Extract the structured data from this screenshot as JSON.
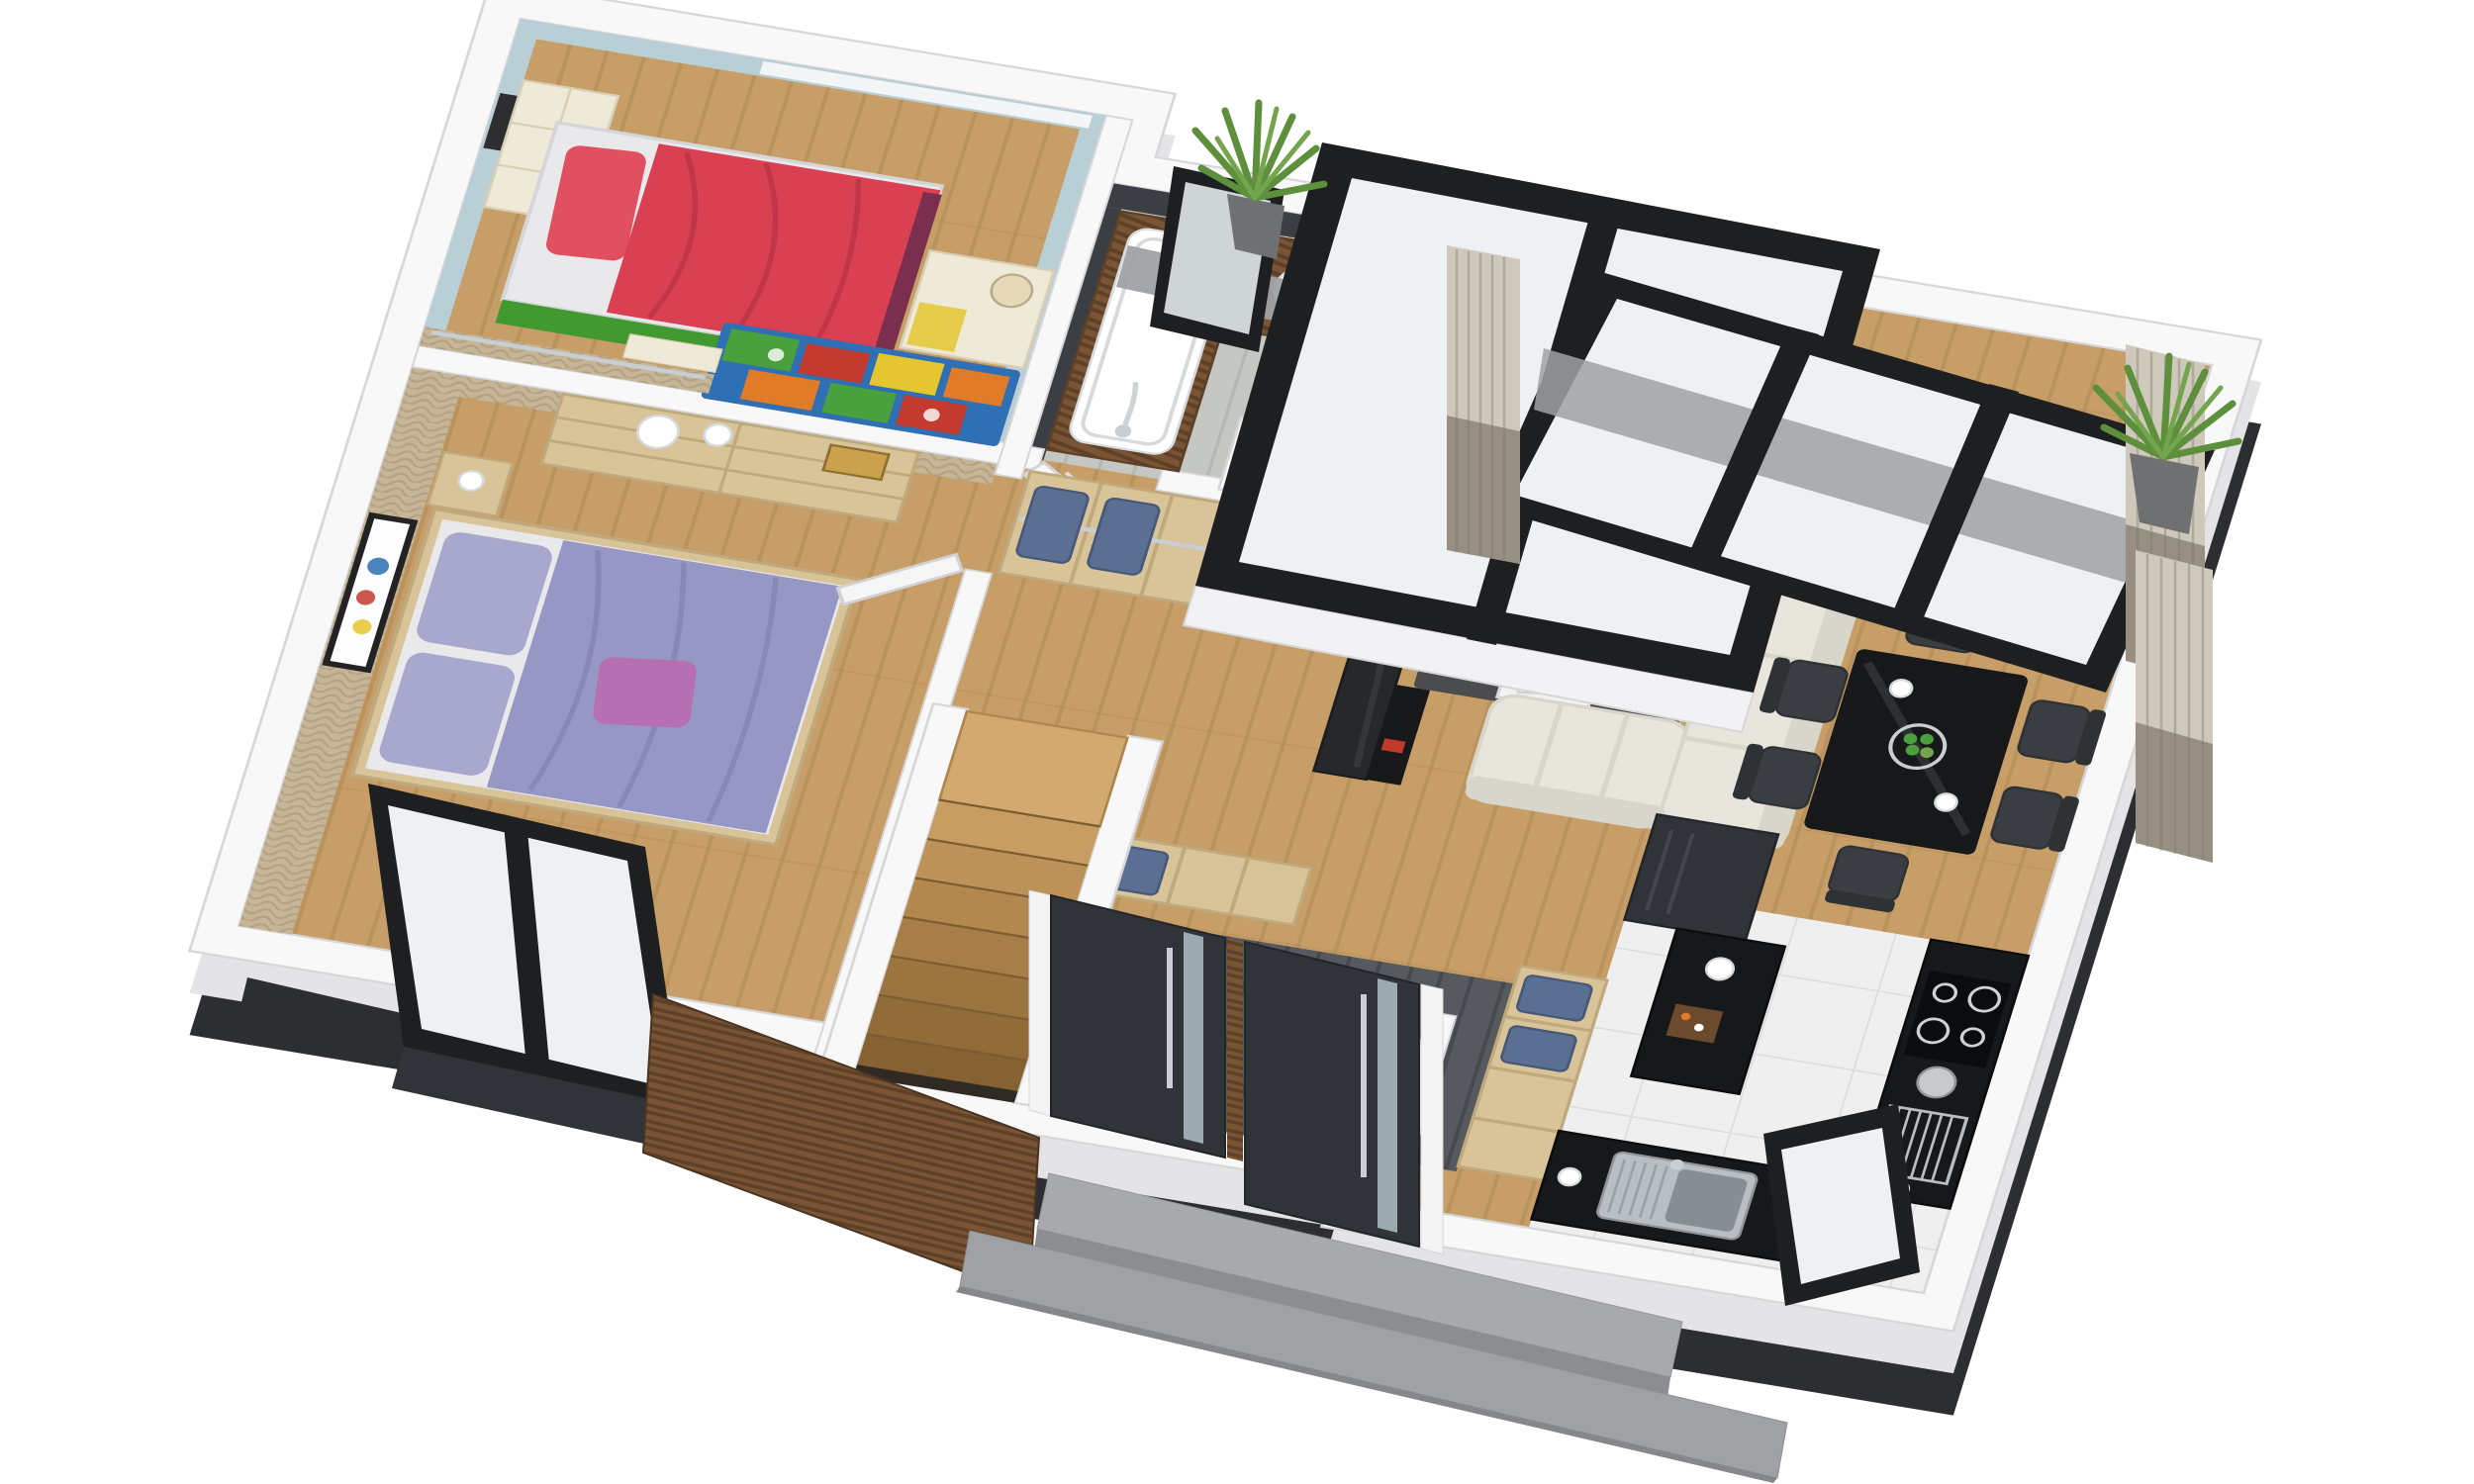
{
  "scene": {
    "type": "3d-isometric-floor-plan-render",
    "background": "white, no visible text or dimensions",
    "rooms": [
      {
        "name": "children-bedroom",
        "position": "top-left",
        "floor": "oak-wood",
        "walls": "light-blue",
        "items": [
          "red-single-bed-green-base",
          "cream-wall-shelf",
          "picture-frame",
          "desk-with-lamp",
          "lime-chair",
          "colorful-play-rug",
          "clothes-rail",
          "black-frame-window-two-panes"
        ]
      },
      {
        "name": "master-bedroom",
        "position": "left",
        "floor": "oak-wood",
        "walls": "wicker-weave",
        "items": [
          "double-bed-lavender-bedding",
          "pink-accent-pillow",
          "six-drawer-dresser",
          "two-white-bowls",
          "books",
          "nightstand-with-vase",
          "colorful-art-frame",
          "white-louver-door",
          "black-frame-sliding-glass-door"
        ]
      },
      {
        "name": "bathroom",
        "position": "top-center",
        "floor": "gray-plank-tile",
        "walls": "anthracite-tile",
        "items": [
          "bathtub-wood-deck",
          "chrome-faucet-running-water",
          "rubber-duck",
          "walnut-vanity-round-vessel-sink",
          "tall-chrome-faucet",
          "vases",
          "toilet",
          "half-wall-niche",
          "framed-mirror",
          "white-louver-door"
        ]
      },
      {
        "name": "hallway",
        "position": "center",
        "floor": "oak-wood",
        "walls": "white",
        "items": [
          "open-wardrobe-cubbies-with-folded-jeans",
          "clothes-rails",
          "winder-staircase-down",
          "second-wardrobe-row",
          "entry-wardrobe-cubbies"
        ]
      },
      {
        "name": "living-dining-room",
        "position": "right",
        "floor": "oak-wood",
        "walls": "white",
        "items": [
          "black-tv-media-wall",
          "red-book",
          "dark-gray-rug",
          "black-coffee-table",
          "bowl-of-green-apples",
          "candle",
          "white-cube-side-tables",
          "magazine",
          "cream-l-shaped-sofa",
          "black-gloss-dining-table",
          "six-dark-chairs",
          "two-white-cups",
          "floor-to-ceiling-black-window",
          "gray-curtains",
          "potted-palms"
        ]
      },
      {
        "name": "kitchen",
        "position": "bottom-right",
        "floor": "white-tile",
        "walls": "white",
        "items": [
          "tall-charcoal-cabinet",
          "black-gloss-counters",
          "ceramic-hob-four-rings",
          "steel-kettle",
          "chrome-dish-rack",
          "stainless-sink-with-drainer",
          "black-frame-window",
          "cutting-board-with-food",
          "white-cups"
        ]
      },
      {
        "name": "entrance",
        "position": "bottom-center",
        "floor": "dark-plank-tile",
        "walls": "white",
        "items": [
          "two-anthracite-front-doors",
          "frosted-glass-strips",
          "steel-bar-handles",
          "walnut-slat-wall",
          "walnut-pillar",
          "two-concrete-steps"
        ]
      }
    ]
  },
  "palette": {
    "bg": "#ffffff",
    "wallTop": "#f8f8f9",
    "wallLine": "#d7d7da",
    "wallSide": "#e4e4e7",
    "plinth": "#2c2e31",
    "wood": "#c79e67",
    "woodDark": "#aa8350",
    "bathFloor": "#c4c7c2",
    "bathFloorDark": "#a9ada7",
    "tile": "#efeff0",
    "tileLine": "#dcdcde",
    "vestibule": "#56595d",
    "vestibuleDark": "#46494d",
    "wicker": "#c6b697",
    "wickerDark": "#ab9a7c",
    "blueWall": "#b9cfd6",
    "cream": "#efe9d8",
    "creamLine": "#d8cfb4",
    "redBed": "#d94052",
    "redBedDark": "#b93343",
    "pillowRed": "#e05060",
    "greenBase": "#41992f",
    "maroon": "#7a2f4f",
    "lime": "#9bc53d",
    "rugBlue": "#2f6fb3",
    "rugGreen": "#4aa03c",
    "rugRed": "#c23b2e",
    "rugOrange": "#e07b28",
    "rugYellow": "#e5c631",
    "lavender": "#a8a7ce",
    "lavenderDark": "#9697c4",
    "pinkPillow": "#b66fb0",
    "sheet": "#e9e9ec",
    "lightWood": "#d9c49a",
    "lightWoodLine": "#c0a97c",
    "walnut": "#7a5535",
    "walnutDark": "#5d4027",
    "tileDark": "#3b3e43",
    "blackGloss": "#17181a",
    "blackGlossHi": "#35373b",
    "charcoal": "#303439",
    "steel": "#c9ced2",
    "steelDark": "#9aa0a5",
    "concrete": "#9fa1a4",
    "concreteDark": "#8a8c8f",
    "curtainLight": "#cfc9bb",
    "curtainDark": "#968f82",
    "plantGreen": "#5d8f3d",
    "plantGreenLight": "#74a44e",
    "jeans": "#5a6f91",
    "jeansDark": "#47597a",
    "sofa": "#e7e5dc",
    "sofaShadow": "#d8d6ca",
    "rugGray": "#4a4c4e",
    "white": "#ffffff",
    "glass": "#eef1f4",
    "frameBlack": "#1d1f21",
    "potGray": "#6e7072",
    "duck": "#f2c91d",
    "apple": "#4aa03c",
    "cuttingBoard": "#6b4a2e"
  }
}
